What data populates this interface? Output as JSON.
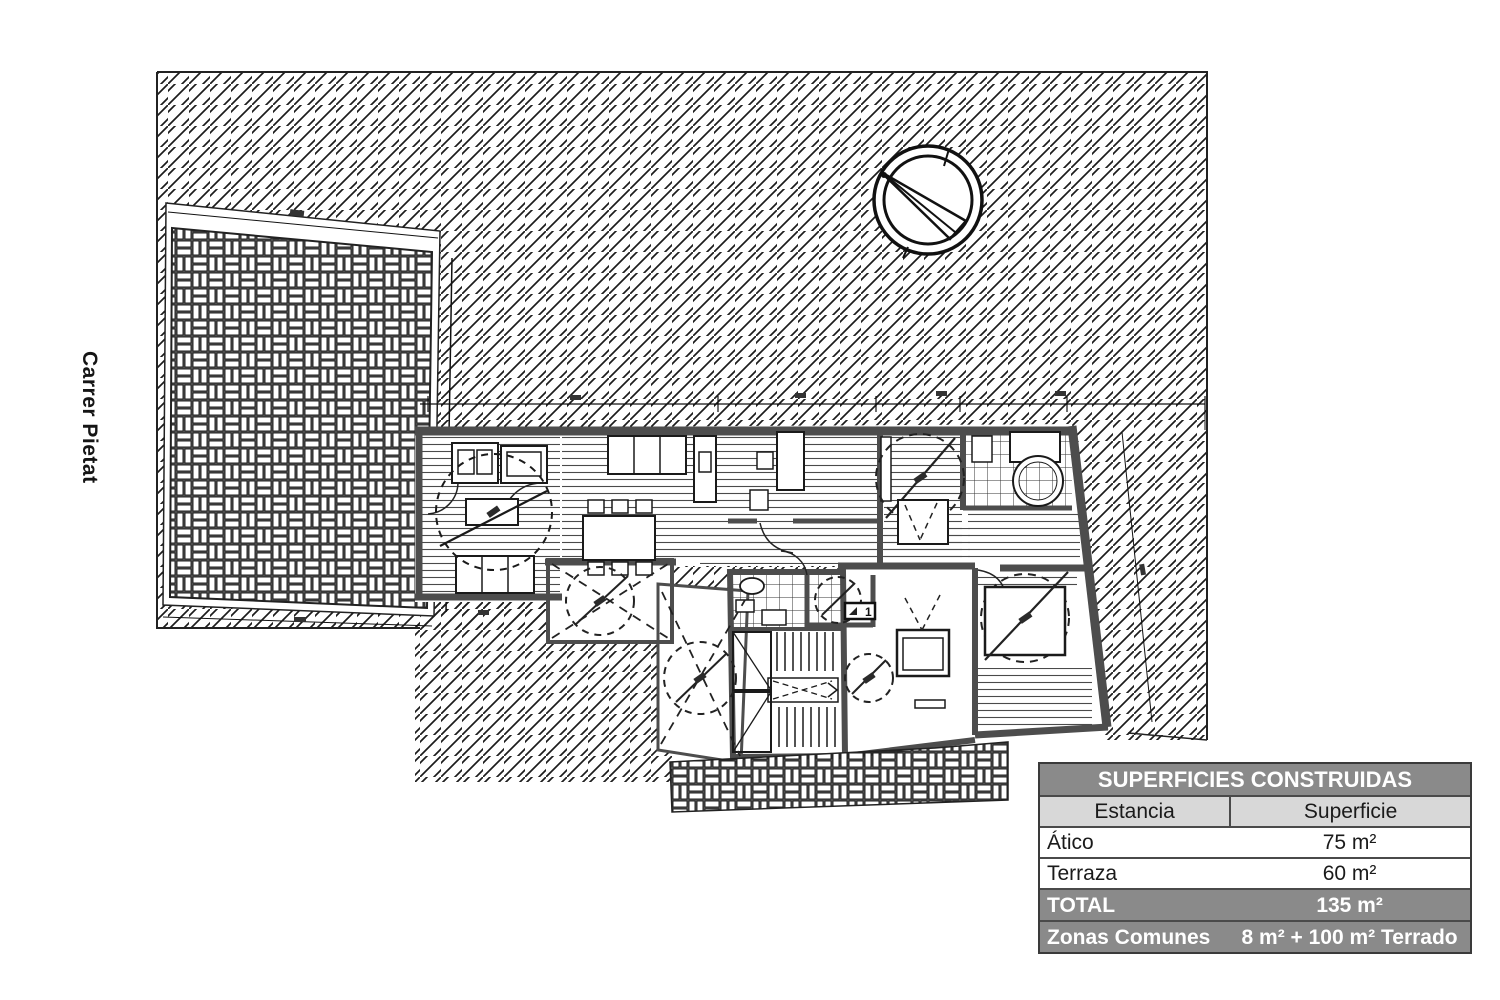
{
  "street_label": "Carrer Pietat",
  "plan": {
    "door_label": "1",
    "north_indicator": "north-arrow"
  },
  "areas_table": {
    "title": "SUPERFICIES CONSTRUIDAS",
    "col_estancia": "Estancia",
    "col_superficie": "Superficie",
    "rows": [
      {
        "estancia": "Ático",
        "superficie": "75 m²"
      },
      {
        "estancia": "Terraza",
        "superficie": "60 m²"
      },
      {
        "estancia": "TOTAL",
        "superficie": "135 m²"
      },
      {
        "estancia": "Zonas Comunes",
        "superficie": "8 m² + 100 m² Terrado"
      }
    ]
  },
  "colors": {
    "wall_gray": "#4d4d4d",
    "ink": "#1a1a1a",
    "table_header_bg": "#8a8a8a",
    "table_subheader_bg": "#d8d8d8",
    "table_border": "#3a3a3a"
  }
}
